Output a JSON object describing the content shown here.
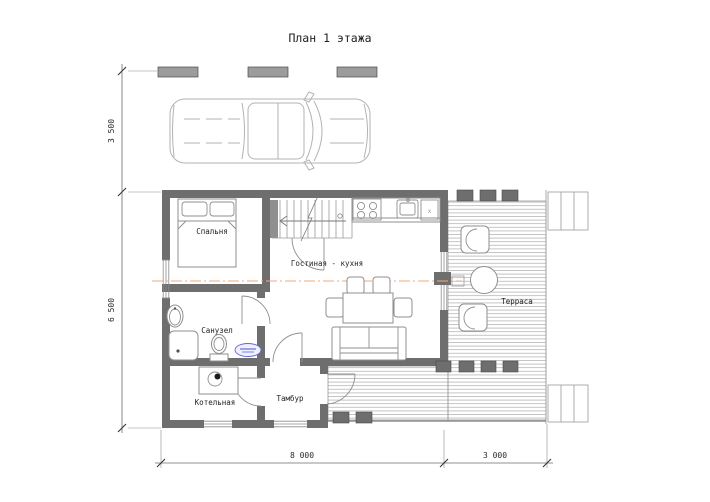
{
  "title": "План 1 этажа",
  "rooms": {
    "bedroom": "Спальня",
    "bathroom": "Санузел",
    "boiler_room": "Котельная",
    "vestibule": "Тамбур",
    "living_kitchen": "Гостиная - кухня",
    "terrace": "Терраса"
  },
  "dimensions": {
    "left_top": "3 500",
    "left_bottom": "6 500",
    "bottom_house": "8 000",
    "bottom_terrace": "3 000"
  },
  "kitchen": {
    "appliance_mark": "x"
  },
  "colors": {
    "wall": "#6e6e6e",
    "deck_line": "#ababab",
    "section_line": "#f0aa78",
    "stamp_blue": "#5050cc"
  }
}
